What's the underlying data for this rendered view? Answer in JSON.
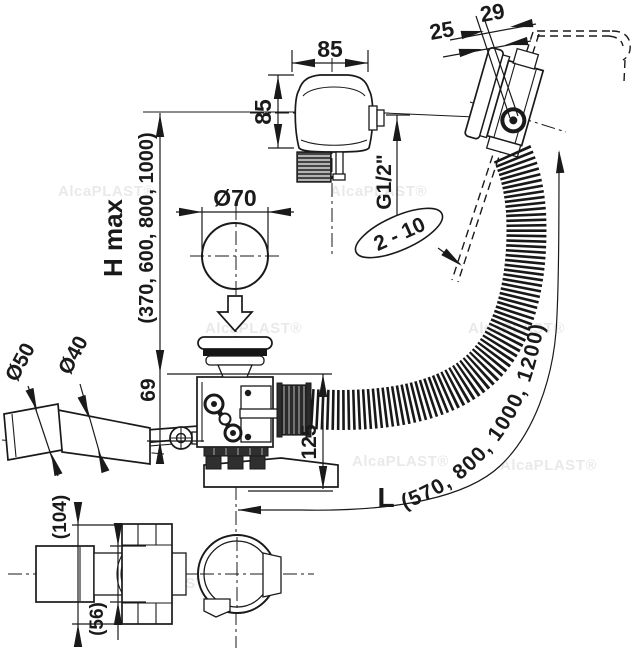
{
  "watermark": {
    "text": "AlcaPLAST®"
  },
  "labels": {
    "knob_width": "85",
    "knob_height": "85",
    "overflow_total_depth": "29",
    "overflow_wall_offset": "25",
    "thread_size": "G1/2\"",
    "tub_wall_thickness": "2 - 10",
    "plug_diameter": "Ø70",
    "hmax_label": "H max",
    "hmax_values": "(370, 600, 800, 1000)",
    "height_above_tub": "69",
    "depth_below_tub": "125",
    "outlet_outer_diameter": "Ø50",
    "outlet_inner_diameter": "Ø40",
    "hose_length_label": "L",
    "hose_length_values": "(570, 800, 1000, 1200)",
    "bottom_view_overall": "(104)",
    "bottom_view_collar": "(56)"
  }
}
